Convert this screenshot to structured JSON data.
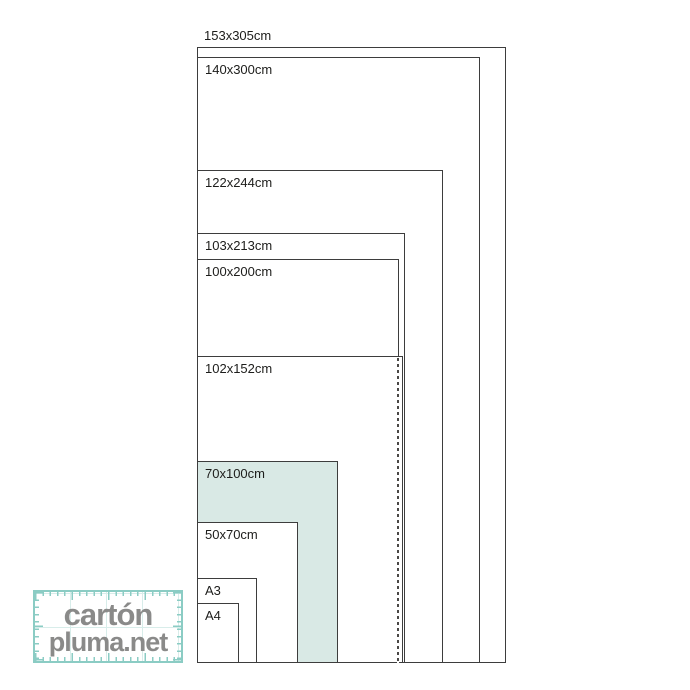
{
  "page": {
    "background_color": "#ffffff",
    "description_texts": []
  },
  "diagram": {
    "scale_px_per_cm": 2.02,
    "anchor": {
      "left_px": 197,
      "bottom_px": 663
    },
    "border_color": "#3d3d3d",
    "label_color": "#1d1d1b",
    "highlight_fill": "#d9e9e5",
    "sizes": [
      {
        "label": "153x305cm",
        "w_cm": 153,
        "h_cm": 305,
        "fill": "#ffffff",
        "label_position": "above",
        "highlighted": false
      },
      {
        "label": "140x300cm",
        "w_cm": 140,
        "h_cm": 300,
        "fill": "#ffffff",
        "label_position": "inside",
        "highlighted": false
      },
      {
        "label": "122x244cm",
        "w_cm": 122,
        "h_cm": 244,
        "fill": "#ffffff",
        "label_position": "inside",
        "highlighted": false
      },
      {
        "label": "103x213cm",
        "w_cm": 103,
        "h_cm": 213,
        "fill": "#ffffff",
        "label_position": "inside",
        "highlighted": false
      },
      {
        "label": "100x200cm",
        "w_cm": 100,
        "h_cm": 200,
        "fill": "#ffffff",
        "label_position": "inside",
        "highlighted": false
      },
      {
        "label": "102x152cm",
        "w_cm": 102,
        "h_cm": 152,
        "fill": "#ffffff",
        "label_position": "inside",
        "highlighted": false
      },
      {
        "label": "70x100cm",
        "w_cm": 70,
        "h_cm": 100,
        "fill": "#d9e9e5",
        "label_position": "inside",
        "highlighted": true
      },
      {
        "label": "50x70cm",
        "w_cm": 50,
        "h_cm": 70,
        "fill": "#ffffff",
        "label_position": "inside",
        "highlighted": false
      },
      {
        "label": "A3",
        "w_cm": 29.7,
        "h_cm": 42,
        "fill": "#ffffff",
        "label_position": "inside",
        "highlighted": false
      },
      {
        "label": "A4",
        "w_cm": 21,
        "h_cm": 29.7,
        "fill": "#ffffff",
        "label_position": "inside",
        "highlighted": false
      }
    ],
    "hidden_edge": {
      "of_size": "100x200cm",
      "behind_size": "102x152cm",
      "x_cm": 100,
      "height_cm": 152
    }
  },
  "logo": {
    "line1": "cartón",
    "line2": "pluma.net",
    "text_color": "#8a8a89",
    "accent_color": "#8bccc4",
    "grid_color": "#d8edea"
  }
}
